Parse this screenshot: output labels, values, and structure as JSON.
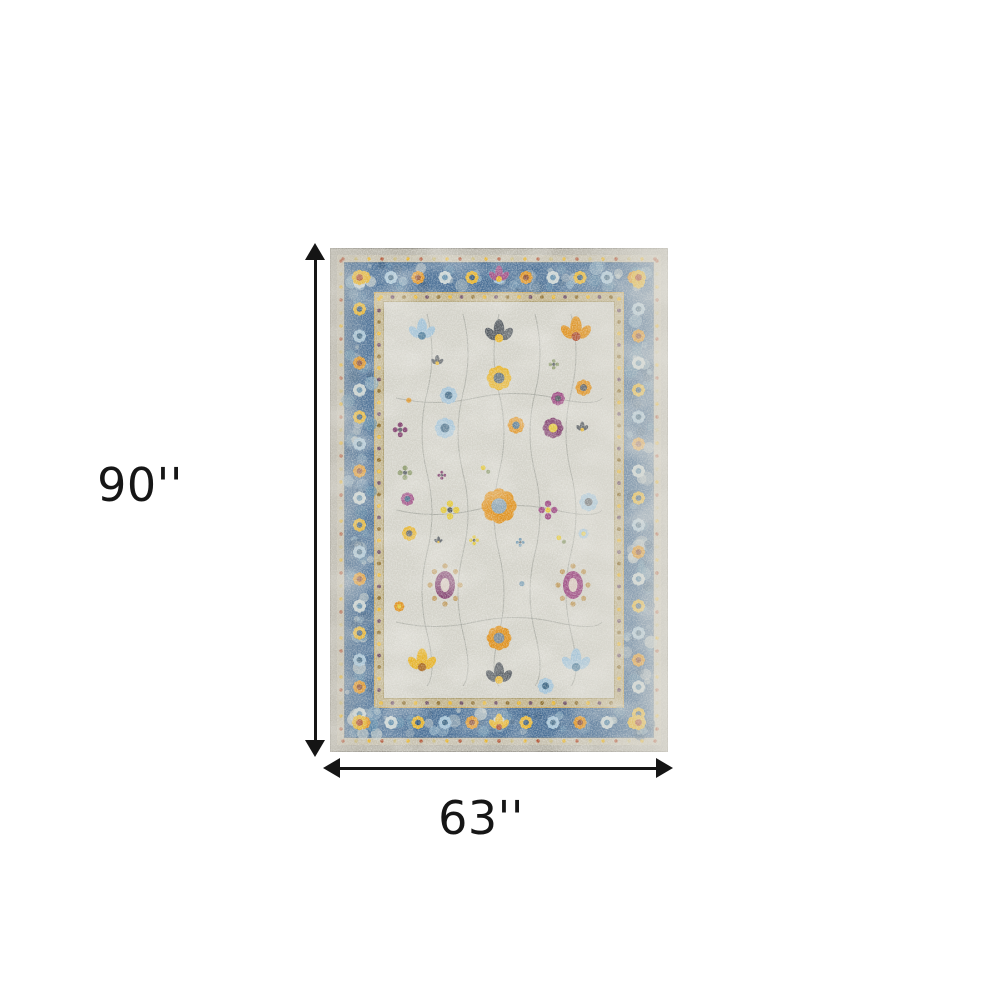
{
  "image": {
    "description": "Product dimension diagram of a vintage-style distressed oriental area rug on a white background",
    "background_color": "#ffffff"
  },
  "dimensions": {
    "height_label": "90''",
    "width_label": "63''",
    "arrow_color": "#151515",
    "label_color": "#161616"
  },
  "rug": {
    "alt": "Blue and ivory distressed traditional rug with multicolor floral motifs",
    "palette": {
      "binding": "#b6b3a8",
      "outer_guard": "#c6c0ae",
      "border_blue": "#4a7097",
      "border_blue_deep": "#35597c",
      "border_blue_light": "#8fb0c4",
      "guard_tan": "#c2b48c",
      "field": "#d4d3ca",
      "frame_gold": "#c9a14e",
      "orange": "#e0921f",
      "gold": "#e7b42c",
      "yellow": "#e3c83e",
      "purple": "#82416f",
      "magenta": "#a04f86",
      "lightblue": "#a3c3d8",
      "blue": "#5d8cab",
      "slate": "#565c62",
      "green": "#8d9b6d",
      "rust": "#b05030",
      "vine": "#8f948c",
      "tan": "#c2a068"
    }
  }
}
